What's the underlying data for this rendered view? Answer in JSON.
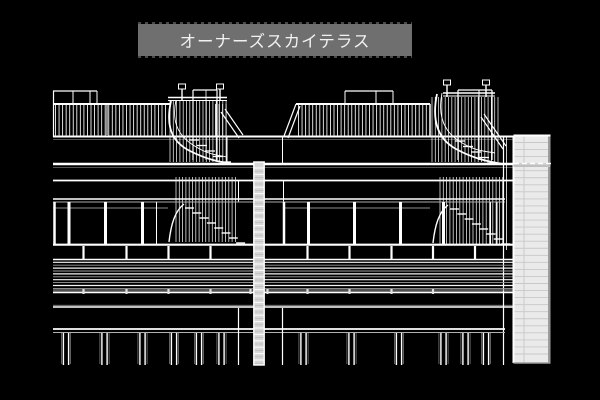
{
  "title": {
    "text": "オーナーズスカイテラス"
  },
  "colors": {
    "background": "#000000",
    "title_bar_bg": "#6f6f6f",
    "title_text": "#f2f2f2",
    "line_primary": "#ffffff",
    "line_dim": "#a0a0a0",
    "shaft_fill": "#eaeaea",
    "shaft_rung": "#c8c8c8",
    "column_fill": "#d6d6d6"
  },
  "drawing": {
    "type": "architectural-elevation-line-drawing"
  }
}
